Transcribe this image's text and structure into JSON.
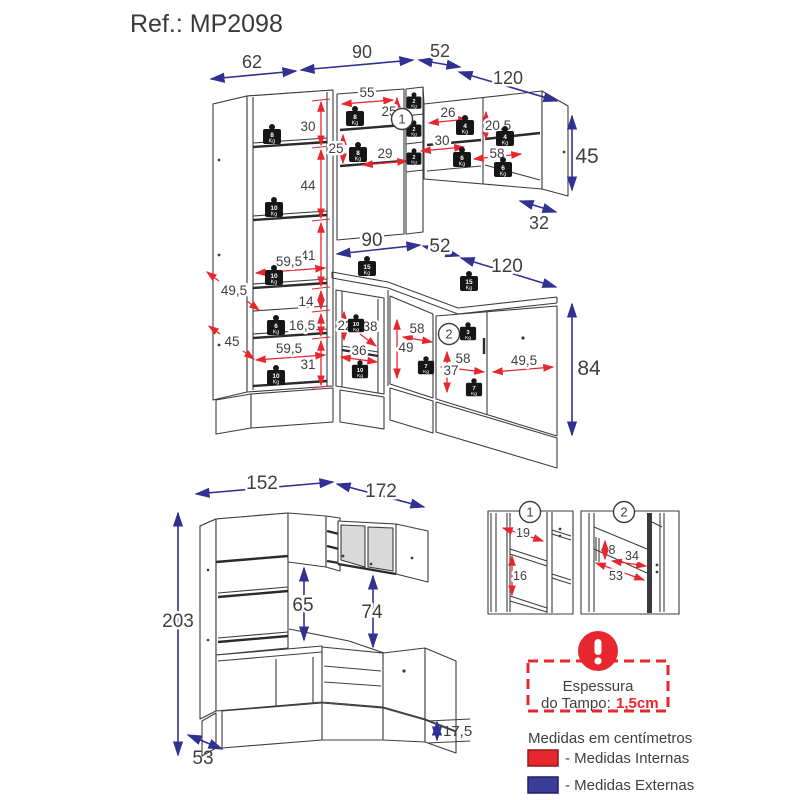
{
  "title": "Ref.: MP2098",
  "kg": "Kg",
  "callout1": "1",
  "callout2": "2",
  "colors": {
    "internal": "#e8262d",
    "external": "#2f3193"
  },
  "upper": {
    "external": {
      "w62": "62",
      "w90": "90",
      "w52": "52",
      "w120": "120",
      "h45": "45",
      "d32": "32",
      "w90b": "90",
      "w52b": "52",
      "w120b": "120",
      "h84": "84"
    },
    "tall": {
      "s30": "30",
      "s44": "44",
      "s41": "41",
      "s14": "14",
      "s165": "16,5",
      "s31": "31",
      "w595a": "59,5",
      "w595b": "59,5",
      "d495": "49,5",
      "d45": "45"
    },
    "mid": {
      "w55": "55",
      "h25a": "25",
      "h25b": "25",
      "w29": "29"
    },
    "wall": {
      "w26": "26",
      "h205": "20,5",
      "w30": "30",
      "w58": "58"
    },
    "base_mid": {
      "h22": "22",
      "d38": "38",
      "w36": "36"
    },
    "base_right": {
      "w58a": "58",
      "h49": "49",
      "w58b": "58",
      "h37": "37",
      "w495": "49,5"
    },
    "weights": {
      "k2": "2",
      "k3": "3",
      "k4": "4",
      "k6": "6",
      "k7": "7",
      "k8": "8",
      "k10": "10",
      "k15": "15"
    }
  },
  "lower": {
    "w152": "152",
    "w172": "172",
    "h203": "203",
    "h65": "65",
    "h74": "74",
    "d53": "53",
    "h175": "17,5"
  },
  "details": {
    "d19": "19",
    "d16": "16",
    "d8": "8",
    "d34": "34",
    "d53": "53"
  },
  "legend": {
    "thickness_line1": "Espessura",
    "thickness_line2": "do Tampo:",
    "thickness_value": "1,5cm",
    "units": "Medidas em centímetros",
    "internal": "- Medidas Internas",
    "external": "- Medidas Externas"
  }
}
